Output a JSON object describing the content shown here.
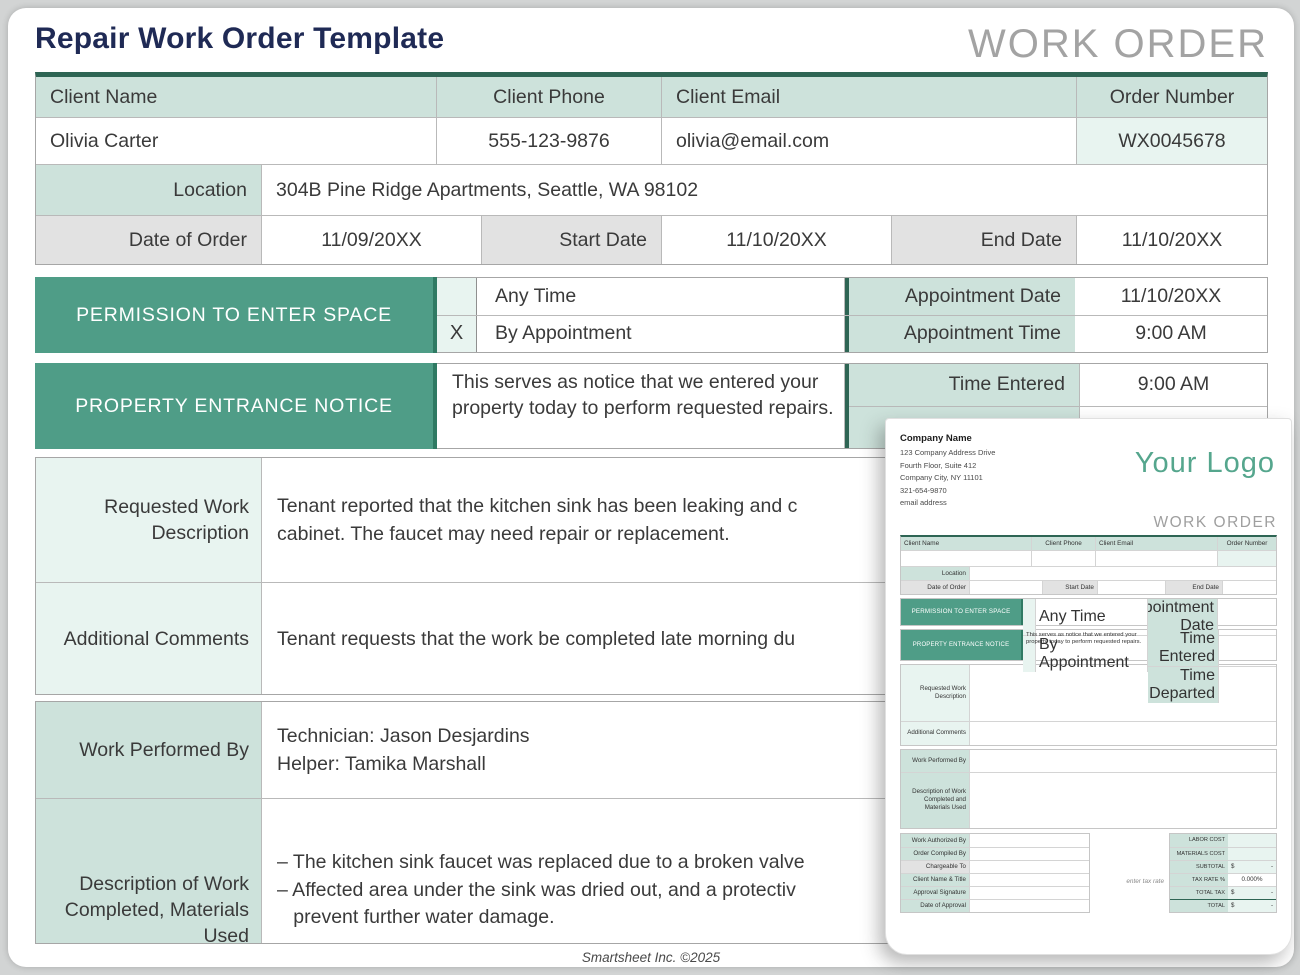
{
  "page": {
    "title": "Repair Work Order Template",
    "watermark": "WORK ORDER",
    "footer": "Smartsheet Inc. ©2025"
  },
  "client_table": {
    "headers": {
      "name": "Client Name",
      "phone": "Client Phone",
      "email": "Client Email",
      "order": "Order Number"
    },
    "values": {
      "name": "Olivia Carter",
      "phone": "555-123-9876",
      "email": "olivia@email.com",
      "order": "WX0045678"
    },
    "location": {
      "label": "Location",
      "value": "304B Pine Ridge Apartments, Seattle, WA 98102"
    },
    "dates": {
      "order_label": "Date of Order",
      "order_value": "11/09/20XX",
      "start_label": "Start Date",
      "start_value": "11/10/20XX",
      "end_label": "End Date",
      "end_value": "11/10/20XX"
    }
  },
  "permission": {
    "title": "PERMISSION TO ENTER SPACE",
    "options": [
      {
        "checked": "",
        "label": "Any Time"
      },
      {
        "checked": "X",
        "label": "By Appointment"
      }
    ],
    "appointment_date_label": "Appointment Date",
    "appointment_date_value": "11/10/20XX",
    "appointment_time_label": "Appointment Time",
    "appointment_time_value": "9:00 AM"
  },
  "entrance": {
    "title": "PROPERTY ENTRANCE NOTICE",
    "notice": "This serves as notice that we entered your property today to perform requested repairs.",
    "time_entered_label": "Time Entered",
    "time_entered_value": "9:00 AM"
  },
  "work": {
    "requested_label": "Requested Work Description",
    "requested_value": "Tenant reported that the kitchen sink has been leaking and c\ncabinet. The faucet may need repair or replacement.",
    "comments_label": "Additional Comments",
    "comments_value": "Tenant requests that the work be completed late morning du",
    "performed_label": "Work Performed By",
    "performed_value": "Technician: Jason Desjardins\nHelper: Tamika Marshall",
    "description_label": "Description of Work Completed, Materials Used",
    "description_value": "– The kitchen sink faucet was replaced due to a broken valve\n– Affected area under the sink was dried out, and a protectiv\n   prevent further water damage."
  },
  "preview": {
    "company_name": "Company Name",
    "company_lines": [
      "123 Company Address Drive",
      "Fourth Floor, Suite 412",
      "Company City, NY 11101",
      "321-654-9870",
      "email address"
    ],
    "logo": "Your Logo",
    "watermark": "WORK ORDER",
    "headers": {
      "name": "Client Name",
      "phone": "Client Phone",
      "email": "Client Email",
      "order": "Order Number"
    },
    "location_label": "Location",
    "date_labels": {
      "order": "Date of Order",
      "start": "Start Date",
      "end": "End Date"
    },
    "permission_title": "PERMISSION TO ENTER SPACE",
    "any_time": "Any Time",
    "by_appointment": "By Appointment",
    "appointment_date": "Appointment Date",
    "appointment_time": "Appointment Time",
    "entrance_title": "PROPERTY ENTRANCE NOTICE",
    "notice": "This serves as notice that we entered your property today to perform requested repairs.",
    "time_entered": "Time Entered",
    "time_departed": "Time Departed",
    "requested_label": "Requested Work Description",
    "comments_label": "Additional Comments",
    "performed_label": "Work Performed By",
    "description_label": "Description of Work Completed and Materials Used",
    "sign_labels": [
      "Work Authorized By",
      "Order Compiled By",
      "Chargeable To",
      "Client Name & Title",
      "Approval Signature",
      "Date of Approval"
    ],
    "tax_note": "enter tax rate",
    "cost_rows": [
      {
        "label": "LABOR COST",
        "prefix": "",
        "value": ""
      },
      {
        "label": "MATERIALS COST",
        "prefix": "",
        "value": ""
      },
      {
        "label": "SUBTOTAL",
        "prefix": "$",
        "value": "-"
      },
      {
        "label": "TAX RATE %",
        "prefix": "",
        "value": "0.000%"
      },
      {
        "label": "TOTAL TAX",
        "prefix": "$",
        "value": "-"
      },
      {
        "label": "TOTAL",
        "prefix": "$",
        "value": "-"
      }
    ]
  }
}
